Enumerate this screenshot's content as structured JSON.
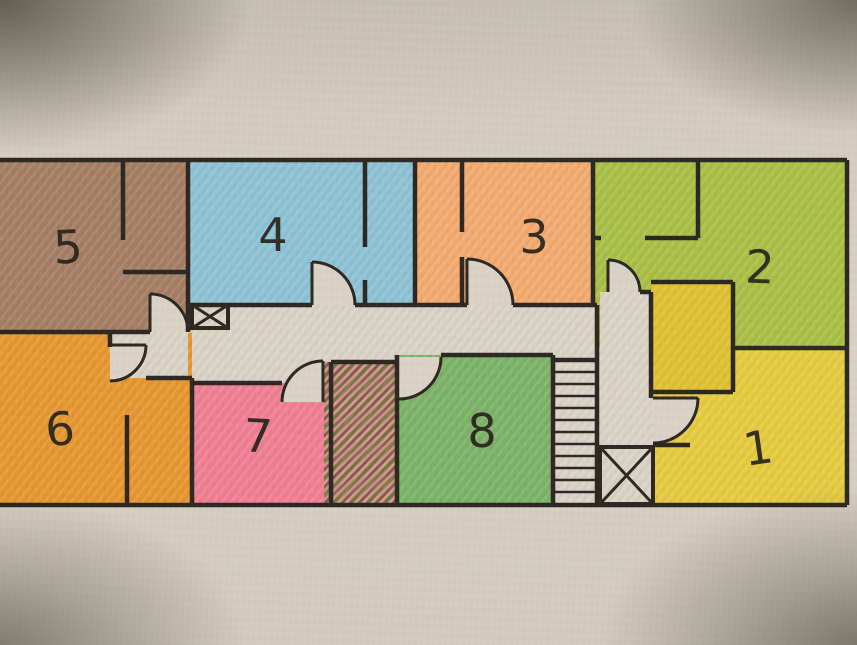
{
  "floorplan": {
    "kind": "hand-drawn floor plan (colored pencil on paper)",
    "rooms": [
      {
        "number": 1,
        "label": "1",
        "color": "#e5cb3e"
      },
      {
        "number": 2,
        "label": "2",
        "color": "#a9bf44"
      },
      {
        "number": 3,
        "label": "3",
        "color": "#f3aa6e"
      },
      {
        "number": 4,
        "label": "4",
        "color": "#8cc3d5"
      },
      {
        "number": 5,
        "label": "5",
        "color": "#a57d64"
      },
      {
        "number": 6,
        "label": "6",
        "color": "#e6962f"
      },
      {
        "number": 7,
        "label": "7",
        "color": "#f07e92"
      },
      {
        "number": 8,
        "label": "8",
        "color": "#7cb269"
      }
    ],
    "closet_color": "#e0c131",
    "corridor_color": "#d9d2c5",
    "paper_color": "#d3ccbf",
    "wall_color": "#2c2721",
    "label_color": "#26221b",
    "hatched_area": {
      "background": "#d6928c",
      "stripe_olive": "#74743f",
      "stripe_brown": "#7d5c49"
    },
    "stairs": {
      "treads": 11
    },
    "shafts": {
      "count": 2,
      "symbol": "crossed-box"
    },
    "doors": {
      "count": 8,
      "symbol": "quarter-circle-swing"
    }
  }
}
